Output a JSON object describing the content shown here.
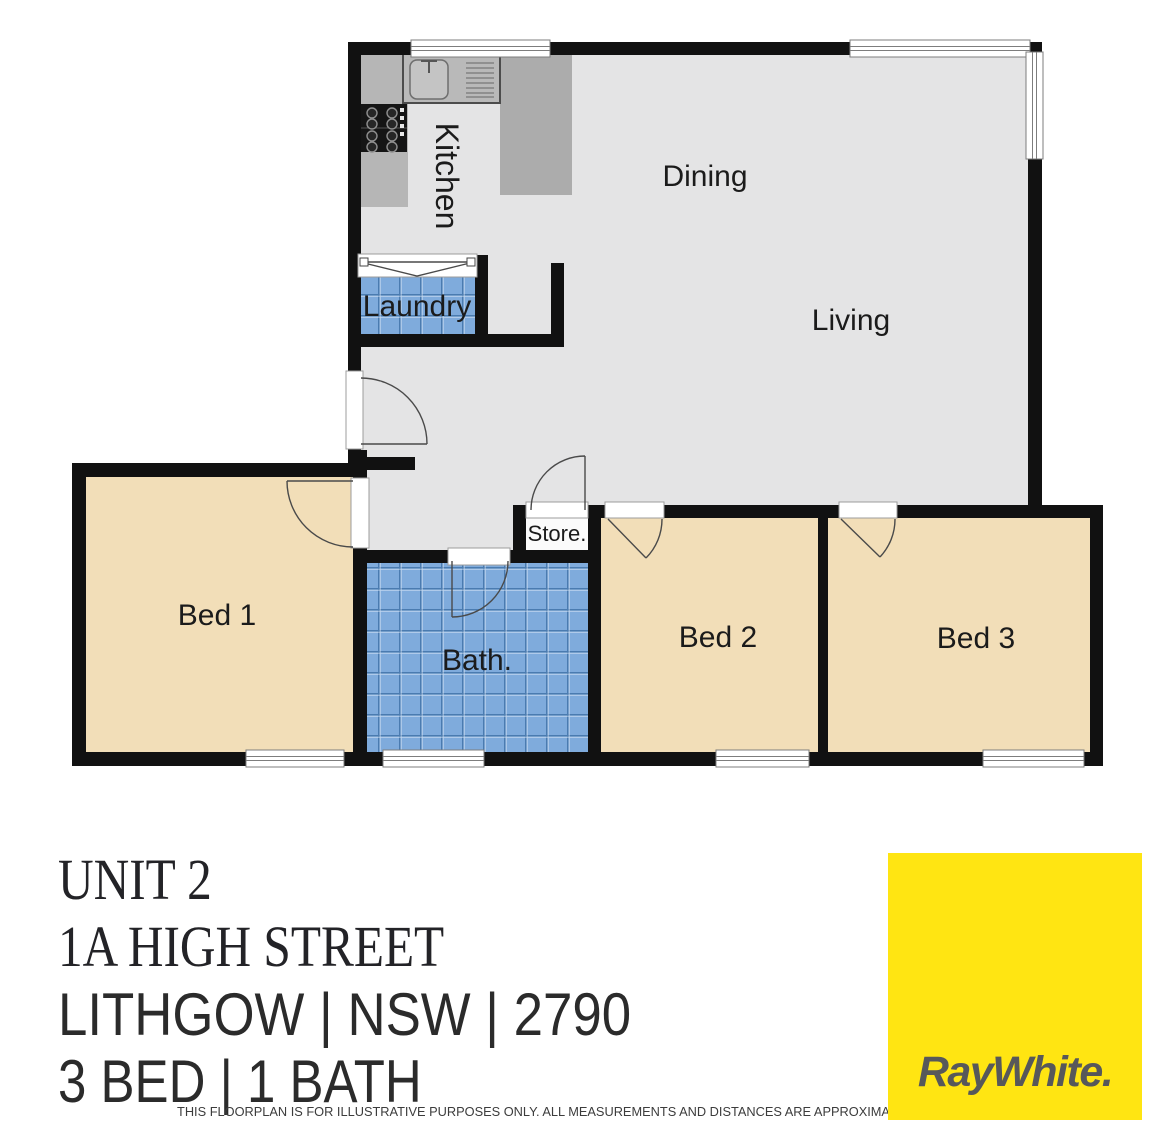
{
  "floorplan": {
    "labels": {
      "kitchen": "Kitchen",
      "dining": "Dining",
      "living": "Living",
      "laundry": "Laundry",
      "bed1": "Bed 1",
      "bath": "Bath.",
      "store": "Store.",
      "bed2": "Bed 2",
      "bed3": "Bed 3"
    },
    "colors": {
      "wall": "#111111",
      "floor": "#E4E4E5",
      "bedroom_floor": "#F2DEB8",
      "tile_blue": "#7FABDC",
      "counter_gray": "#B6B6B6"
    }
  },
  "property": {
    "unit": "UNIT 2",
    "street": "1A HIGH STREET",
    "locality": "LITHGOW | NSW | 2790",
    "features": "3 BED | 1 BATH"
  },
  "disclaimer": {
    "text": "THIS FLOORPLAN IS FOR ILLUSTRATIVE PURPOSES ONLY. ALL MEASUREMENTS AND DISTANCES ARE APPROXIMATE AND NOT TO SCALE."
  },
  "brand": {
    "logo_text": "RayWhite.",
    "bg": "#FFE512",
    "fg": "#57585A"
  }
}
